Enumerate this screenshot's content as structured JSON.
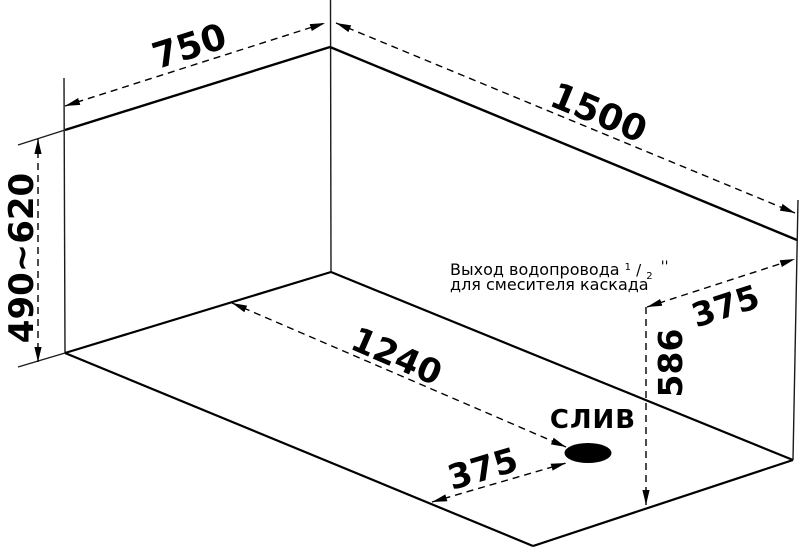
{
  "diagram": {
    "type": "bathtub-dimension-drawing",
    "background_color": "#ffffff",
    "line_color": "#000000",
    "dimensions": {
      "top_width": "750",
      "top_length": "1500",
      "left_height_range": "490~620",
      "floor_diagonal": "1240",
      "drain_offset": "375",
      "outlet_offset": "375",
      "outlet_height": "586"
    },
    "outlet_note": {
      "line1": "Выход водопровода",
      "size_numerator": "1",
      "size_slash": "/",
      "size_denominator": "2",
      "size_unit": "''",
      "line2": "для смесителя каскада"
    },
    "drain_label": "СЛИВ"
  }
}
